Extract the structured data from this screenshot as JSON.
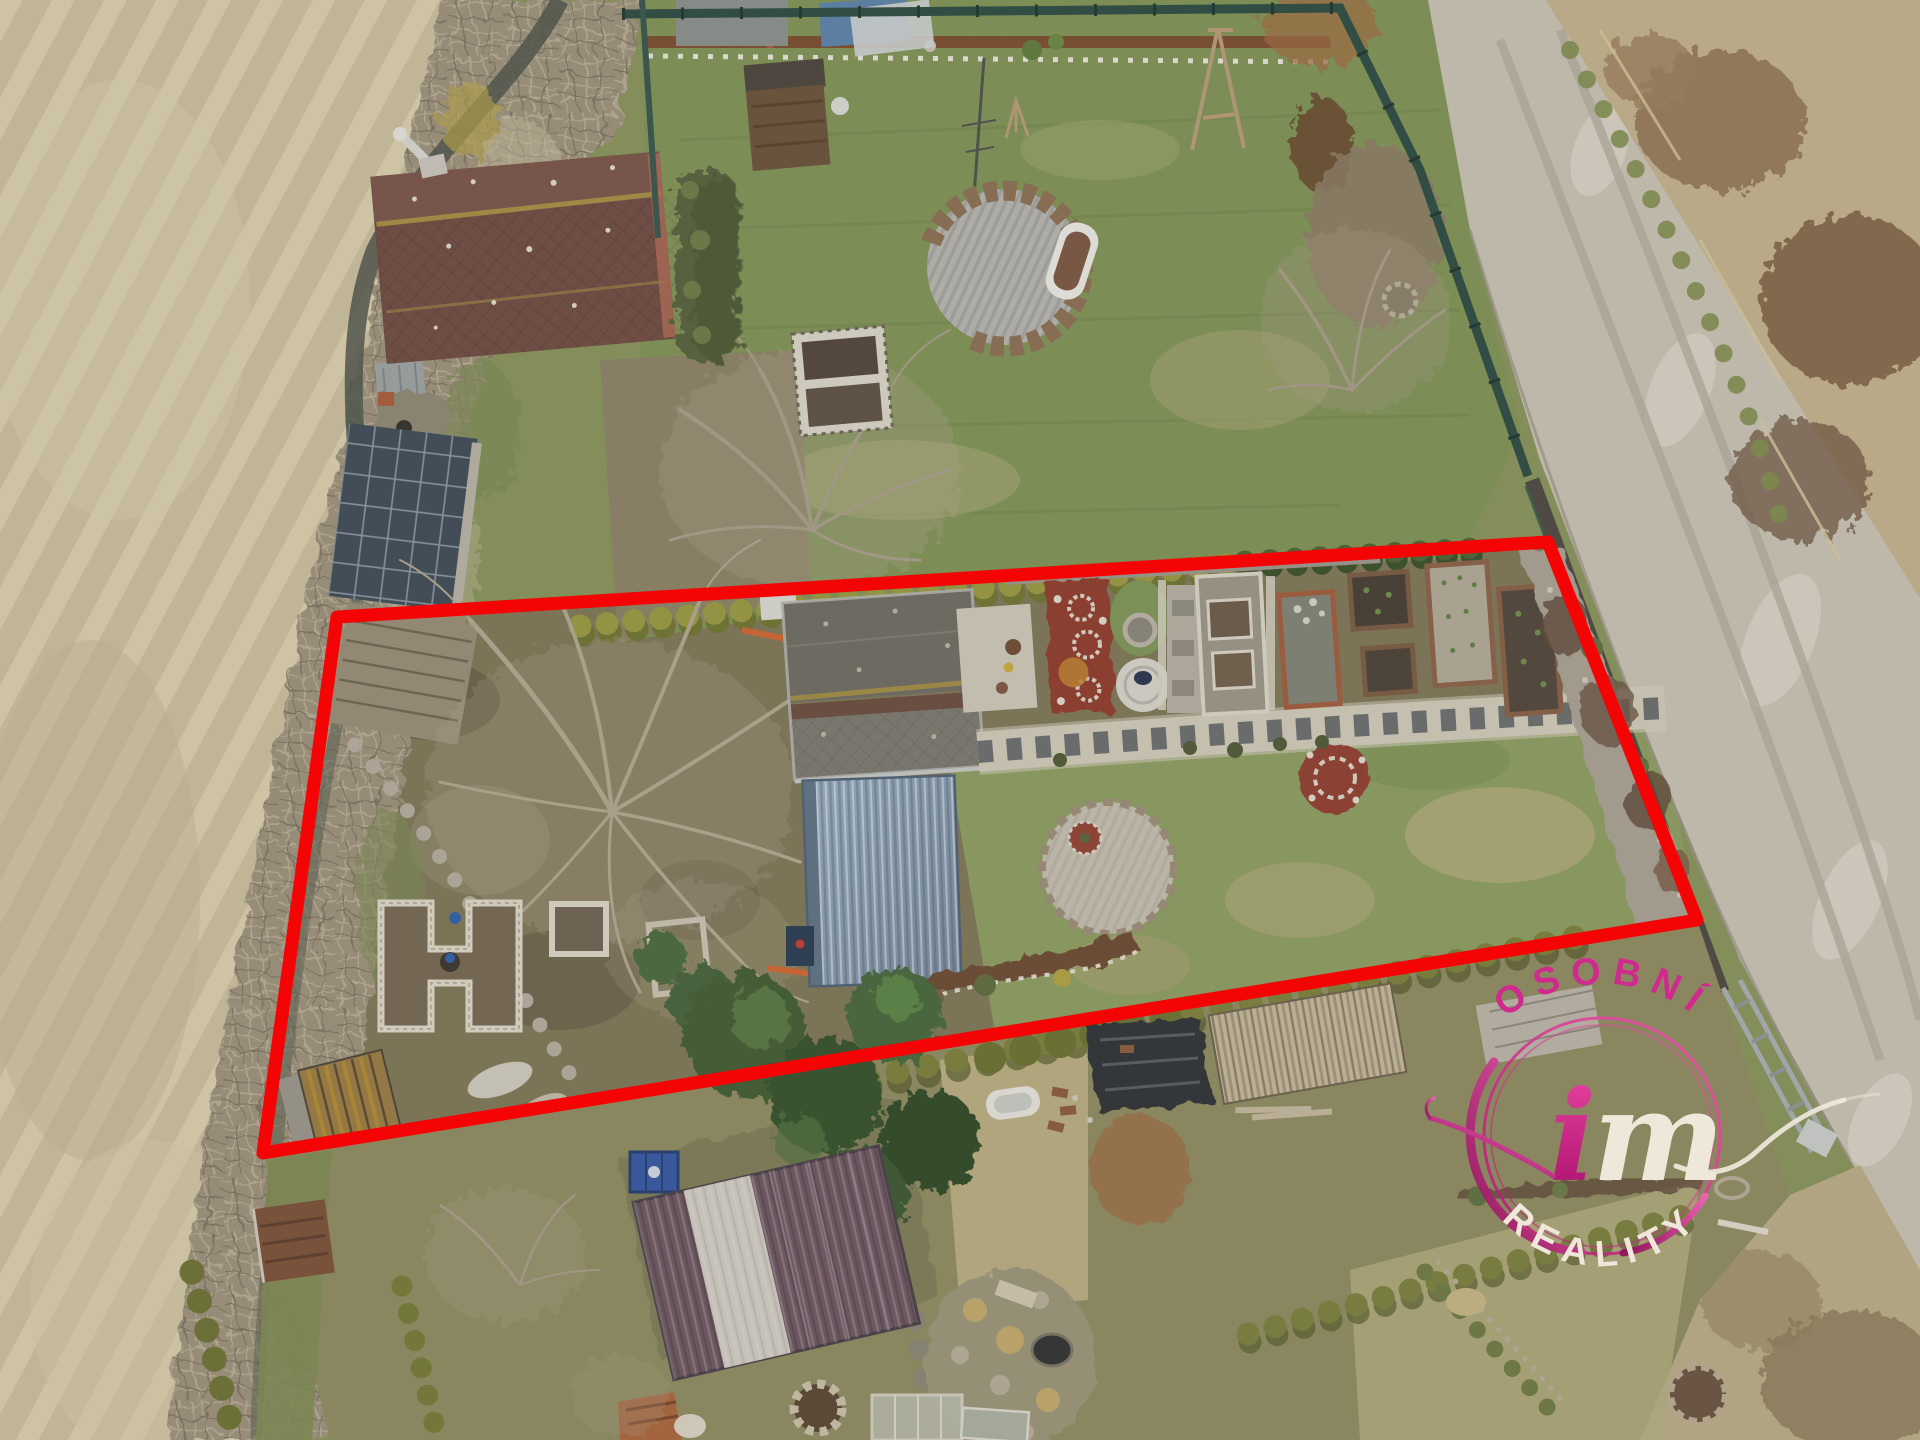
{
  "watermark": {
    "arc_top": "OSOBNÍ",
    "monogram_i": "i",
    "monogram_m": "m",
    "arc_bottom": "REALITY"
  },
  "boundary": {
    "points": "337,617 1548,542 1697,920 263,1153",
    "stroke_width": 13
  },
  "colors": {
    "boundary": "#f40404",
    "brand_pink": "#d12a8e",
    "brand_pink_deep": "#a80d6c",
    "brand_pink_light": "#ef5fb0",
    "brand_ivory": "#efe8da"
  }
}
